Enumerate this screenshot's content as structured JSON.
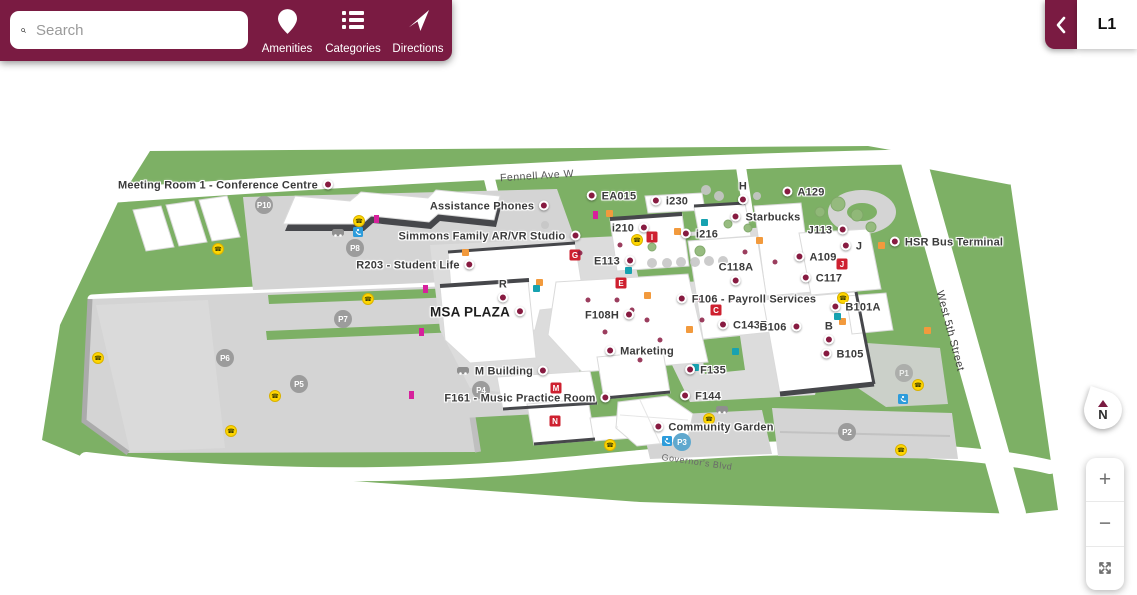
{
  "header": {
    "search": {
      "placeholder": "Search"
    },
    "buttons": [
      {
        "label": "Amenities",
        "icon": "map-pin-icon"
      },
      {
        "label": "Categories",
        "icon": "list-icon"
      },
      {
        "label": "Directions",
        "icon": "navigation-arrow-icon"
      }
    ]
  },
  "level_selector": {
    "level": "L1",
    "collapse_icon": "chevron-left-icon"
  },
  "controls": {
    "compass_label": "N",
    "zoom_in": "+",
    "zoom_out": "−",
    "fullscreen_icon": "expand-icon"
  },
  "map": {
    "streets": [
      "Fennell Ave W",
      "West 5th Street",
      "Governor's Blvd"
    ],
    "labels": [
      {
        "text": "Meeting Room 1 - Conference Centre"
      },
      {
        "text": "Assistance Phones"
      },
      {
        "text": "EA015"
      },
      {
        "text": "i230"
      },
      {
        "text": "H"
      },
      {
        "text": "A129"
      },
      {
        "text": "Starbucks"
      },
      {
        "text": "Simmons Family AR/VR Studio"
      },
      {
        "text": "i210"
      },
      {
        "text": "i216"
      },
      {
        "text": "J113"
      },
      {
        "text": "J"
      },
      {
        "text": "HSR Bus Terminal"
      },
      {
        "text": "R203 - Student Life"
      },
      {
        "text": "E113"
      },
      {
        "text": "C118A"
      },
      {
        "text": "A109"
      },
      {
        "text": "C117"
      },
      {
        "text": "R"
      },
      {
        "text": "MSA PLAZA"
      },
      {
        "text": "F106 - Payroll Services"
      },
      {
        "text": "F108H"
      },
      {
        "text": "C143Z"
      },
      {
        "text": "B106"
      },
      {
        "text": "B"
      },
      {
        "text": "B101A"
      },
      {
        "text": "Marketing"
      },
      {
        "text": "B105"
      },
      {
        "text": "M Building"
      },
      {
        "text": "F135"
      },
      {
        "text": "F161 - Music Practice Room"
      },
      {
        "text": "F144"
      },
      {
        "text": "Community Garden"
      }
    ],
    "parking": [
      "P10",
      "P8",
      "P7",
      "P6",
      "P5",
      "P4",
      "P3",
      "P2",
      "P1"
    ],
    "badges": [
      "G",
      "I",
      "E",
      "J",
      "C",
      "M",
      "N"
    ],
    "icons": [
      "search-icon",
      "map-pin-icon",
      "list-icon",
      "navigation-arrow-icon",
      "chevron-left-icon",
      "compass-needle-icon",
      "plus-icon",
      "minus-icon",
      "expand-icon",
      "emergency-phone-icon",
      "accessibility-icon",
      "car-icon"
    ],
    "colors": {
      "brand_maroon": "#7A1B42",
      "poi_dot": "#871B41",
      "grass_green": "#7DB065",
      "parking_gray": "#D4D4D4",
      "road_white": "#FFFFFF",
      "roof_edge": "#46474B",
      "badge_red": "#CE202F"
    }
  }
}
